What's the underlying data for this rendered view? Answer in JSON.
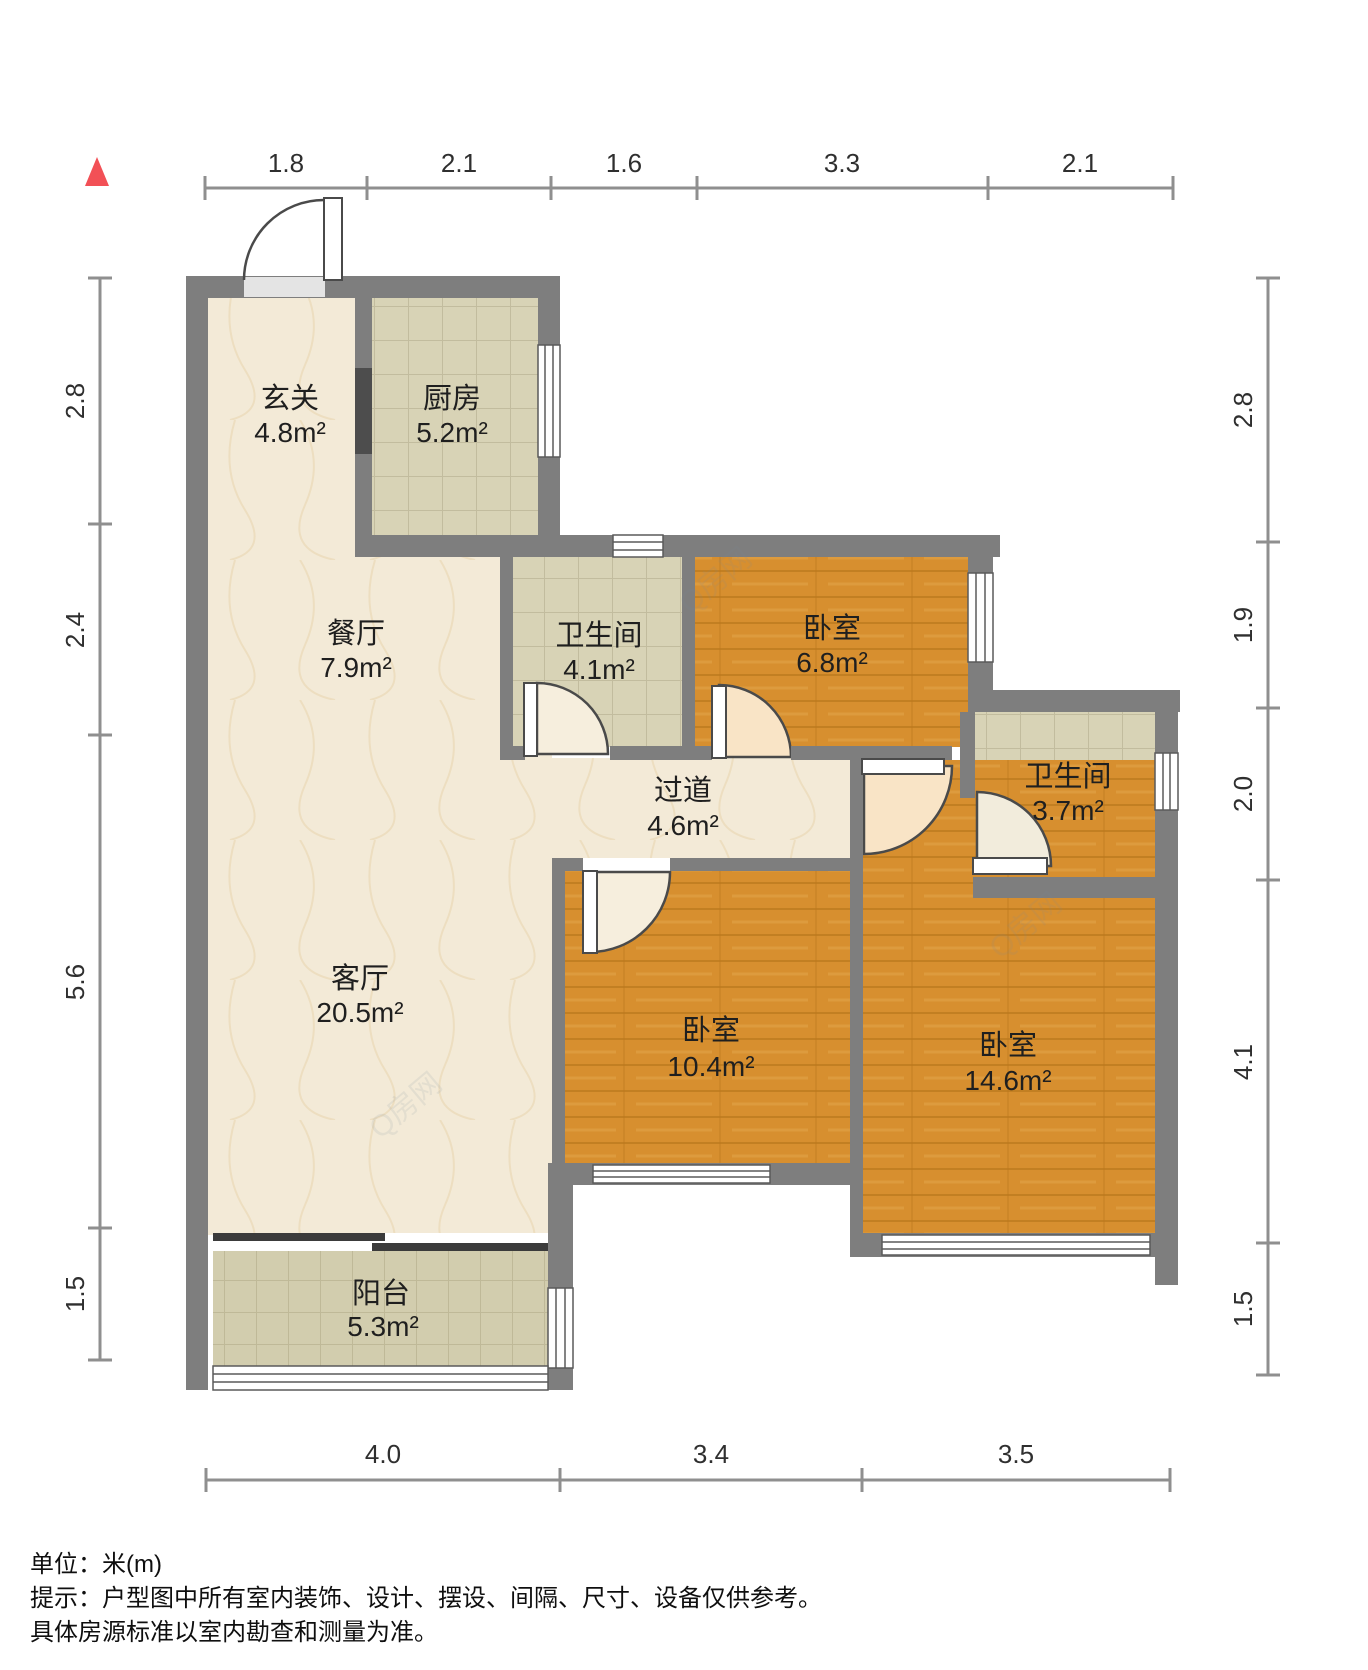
{
  "title": "floor-plan",
  "unit_system": "meters",
  "north_marker": "north-arrow",
  "watermark": "Q房网",
  "rooms": [
    {
      "id": "entry",
      "name": "玄关",
      "area": "4.8m²"
    },
    {
      "id": "kitchen",
      "name": "厨房",
      "area": "5.2m²"
    },
    {
      "id": "dining",
      "name": "餐厅",
      "area": "7.9m²"
    },
    {
      "id": "bath1",
      "name": "卫生间",
      "area": "4.1m²"
    },
    {
      "id": "bedroom1",
      "name": "卧室",
      "area": "6.8m²"
    },
    {
      "id": "hallway",
      "name": "过道",
      "area": "4.6m²"
    },
    {
      "id": "bath2",
      "name": "卫生间",
      "area": "3.7m²"
    },
    {
      "id": "living",
      "name": "客厅",
      "area": "20.5m²"
    },
    {
      "id": "bedroom2",
      "name": "卧室",
      "area": "10.4m²"
    },
    {
      "id": "bedroom3",
      "name": "卧室",
      "area": "14.6m²"
    },
    {
      "id": "balcony",
      "name": "阳台",
      "area": "5.3m²"
    }
  ],
  "dimensions": {
    "top": [
      "1.8",
      "2.1",
      "1.6",
      "3.3",
      "2.1"
    ],
    "left": [
      "2.8",
      "2.4",
      "5.6",
      "1.5"
    ],
    "right": [
      "2.8",
      "1.9",
      "2.0",
      "4.1",
      "1.5"
    ],
    "bottom": [
      "4.0",
      "3.4",
      "3.5"
    ]
  },
  "footer": {
    "unit_label": "单位：米(m)",
    "tip_line1": "提示：户型图中所有室内装饰、设计、摆设、间隔、尺寸、设备仅供参考。",
    "tip_line2": "具体房源标准以室内勘查和测量为准。"
  },
  "colors": {
    "wall": "#7e7e7e",
    "wood_floor": "#d78f2f",
    "tile_floor": "#d8d3b6",
    "marble_floor": "#f3ead7",
    "north_red": "#f25056"
  }
}
